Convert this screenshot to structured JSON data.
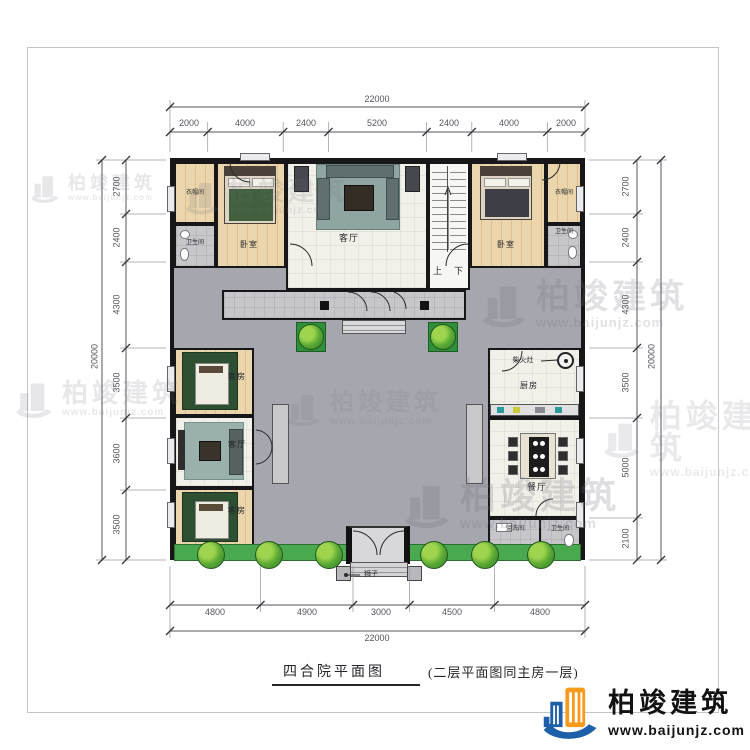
{
  "title": {
    "main": "四合院平面图",
    "note": "(二层平面图同主房一层)"
  },
  "brand": {
    "name": "柏竣建筑",
    "url": "www.baijunjz.com",
    "blue": "#1d5fa8",
    "orange": "#f59a1d"
  },
  "watermark": {
    "name": "柏竣建筑",
    "url": "www.baijunjz.com"
  },
  "dimensions": {
    "top": {
      "total": "22000",
      "segments": [
        "2000",
        "4000",
        "2400",
        "5200",
        "2400",
        "4000",
        "2000"
      ]
    },
    "bottom": {
      "total": "22000",
      "segments": [
        "4800",
        "4900",
        "3000",
        "4500",
        "4800"
      ]
    },
    "left": {
      "total": "20000",
      "segments": [
        "2700",
        "2400",
        "4300",
        "3500",
        "3600",
        "3500"
      ]
    },
    "right": {
      "total": "20000",
      "segments": [
        "2700",
        "2400",
        "4300",
        "3500",
        "5000",
        "2100"
      ]
    }
  },
  "rooms": {
    "closet_left": "衣帽间",
    "bath_left": "卫生间",
    "bedroom_left": "卧室",
    "main_hall": "客厅",
    "stair_up": "上",
    "stair_down": "下",
    "bedroom_right": "卧室",
    "closet_right": "衣帽间",
    "bath_right": "卫生间",
    "guest_room_1": "客房",
    "west_living": "客厅",
    "guest_room_2": "客房",
    "kitchen": "厨房",
    "dining": "餐厅",
    "washroom": "盥洗间",
    "bath_south": "卫生间"
  },
  "callouts": {
    "wood_stove": "柴火灶",
    "lion": "狮子"
  },
  "colors": {
    "courtyard": "#a6a6ae",
    "lawn": "#49a94f",
    "wood_floor": "#e6cfa3"
  }
}
